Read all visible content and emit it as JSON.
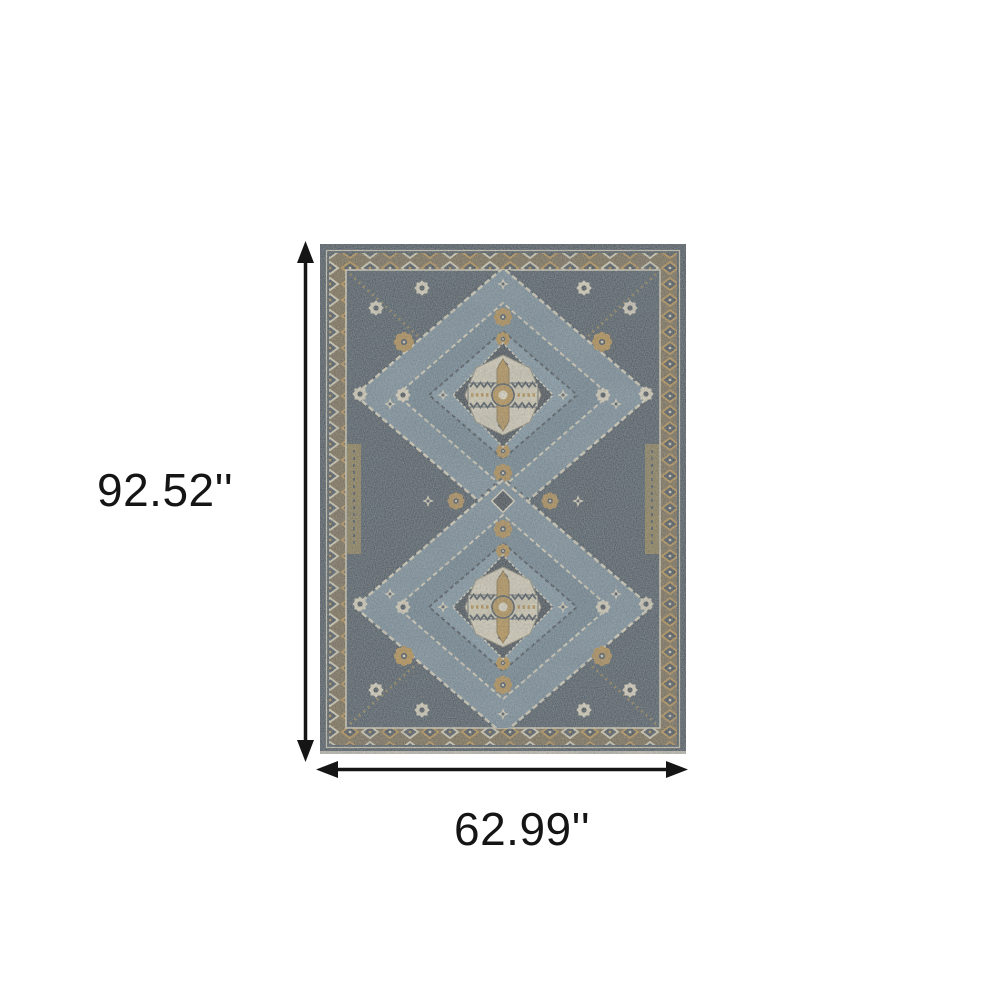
{
  "page": {
    "background_color": "#ffffff"
  },
  "annotation": {
    "height_label": "92.52''",
    "width_label": "62.99''",
    "arrow_color": "#151515"
  },
  "rug": {
    "description": "Blue and gold oriental area rug with two stepped diamond medallions",
    "colors": {
      "edge": "#36495c",
      "border_ground": "#7b6a47",
      "border_diamond_cream": "#d8d1ba",
      "border_diamond_gold": "#bb953f",
      "guard_stripe": "#d9d3bf",
      "field": "#3b5062",
      "diamond_outer": "#7b93a3",
      "diamond_mid": "#6d8798",
      "diamond_inner": "#829bab",
      "medallion_navy": "#24394d",
      "medallion_cream": "#ddd6c2",
      "accent_gold": "#c09a45",
      "accent_navy": "#2c3f52",
      "hook_gold": "#a08846",
      "fringe": "#d8d3c3"
    }
  }
}
